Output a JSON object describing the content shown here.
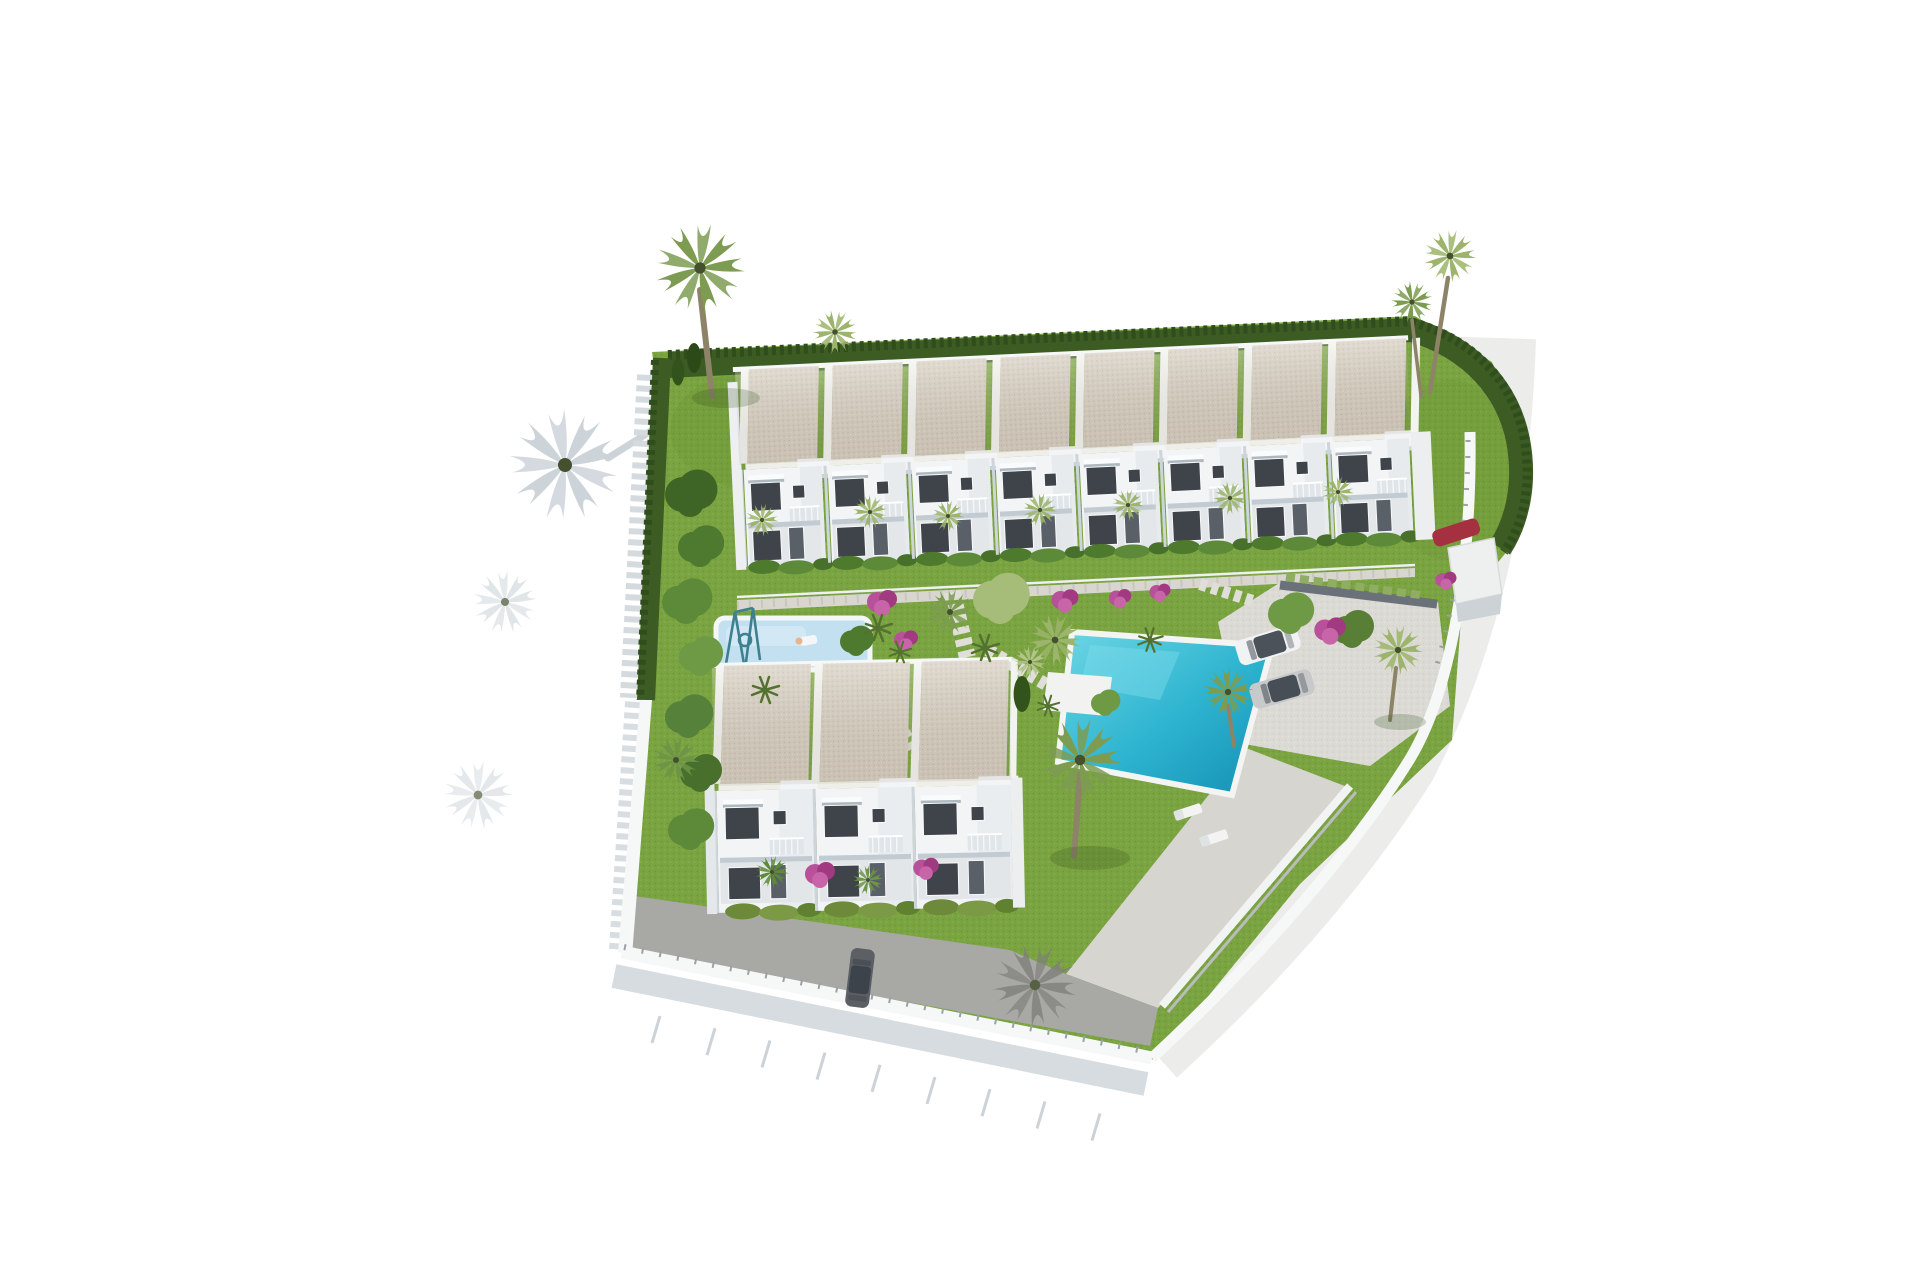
{
  "scene": {
    "kind": "3D aerial architectural render",
    "setting": "White-washed coastal townhouse development seen from above, surrounded by blank white ground",
    "background": "#ffffff"
  },
  "palette": {
    "background": "#ffffff",
    "grass": "#7aa341",
    "grass_dark": "#6a9435",
    "grass_light": "#8ab24e",
    "hedge_dark": "#3c5c23",
    "hedge_deep": "#2f4d1d",
    "roof_beige": "#d5cdbf",
    "roof_speck": "#c1b7a6",
    "facade_white": "#f3f4f6",
    "facade_shadow": "#dbe0e5",
    "window_dark": "#3f444a",
    "door_gray": "#596067",
    "pool_light": "#6ed7e5",
    "pool_mid": "#2cb3cf",
    "pool_deep": "#148fb3",
    "kids_pool": "#c2e0f0",
    "concrete": "#dcdad4",
    "asphalt": "#a8a8a4",
    "road": "#ecedeb",
    "wall_white": "#f6f7f7",
    "shadow_soft": "#d2d9dd",
    "flower_pink": "#b8509a",
    "flower_magenta": "#a23a82",
    "palm_mid": "#7d9c52",
    "palm_light": "#9cb46b",
    "trunk_brown": "#8d8468",
    "swing_teal": "#3d808f",
    "car_white": "#f0f2f3",
    "car_silver": "#c7c9cb",
    "car_dark": "#5c6064",
    "car_red": "#a53040"
  },
  "site": {
    "buildings": [
      {
        "id": "north-row",
        "type": "two-storey terraced townhouses",
        "units": 8,
        "unit_step_px": 84,
        "roof": "flat beige gravel roofs with white party ridges",
        "facade": "white with dark glazing and balconies"
      },
      {
        "id": "south-block",
        "type": "two-storey terraced townhouses",
        "units": 3,
        "unit_step_px": 99,
        "roof": "flat beige gravel roofs with white party ridges",
        "facade": "white with dark glazing, pink bougainvillea"
      }
    ],
    "amenities": {
      "main_pool": {
        "shape": "rectangular",
        "water": "turquoise",
        "white_deck_platform": true,
        "sun_loungers": 2
      },
      "kids_pool": {
        "shape": "small rectangular",
        "water": "pale blue",
        "swing_frame": true
      },
      "gardens": "communal lawns with stepping-stone paths, clipped conifer hedges, fan palms, shrubs and pink bougainvillea"
    },
    "vehicles": [
      {
        "location": "parking pad",
        "color_key": "car_white"
      },
      {
        "location": "parking pad",
        "color_key": "car_silver"
      },
      {
        "location": "behind entrance shelter",
        "color_key": "car_red"
      },
      {
        "location": "bottom driveway",
        "color_key": "car_dark"
      }
    ],
    "perimeter": {
      "hedge": "dark clipped hedge along north and east boundary",
      "wall": "white boundary wall with thin railing along south and west",
      "road": "curved light access road sweeping around the east and south-east corner",
      "curb_ticks": 9
    },
    "trees": {
      "tall_fan_palms": 4,
      "garden_palms": "many small fan palms",
      "shadows": "palm and hedge shadows cast to the lower-left"
    }
  }
}
